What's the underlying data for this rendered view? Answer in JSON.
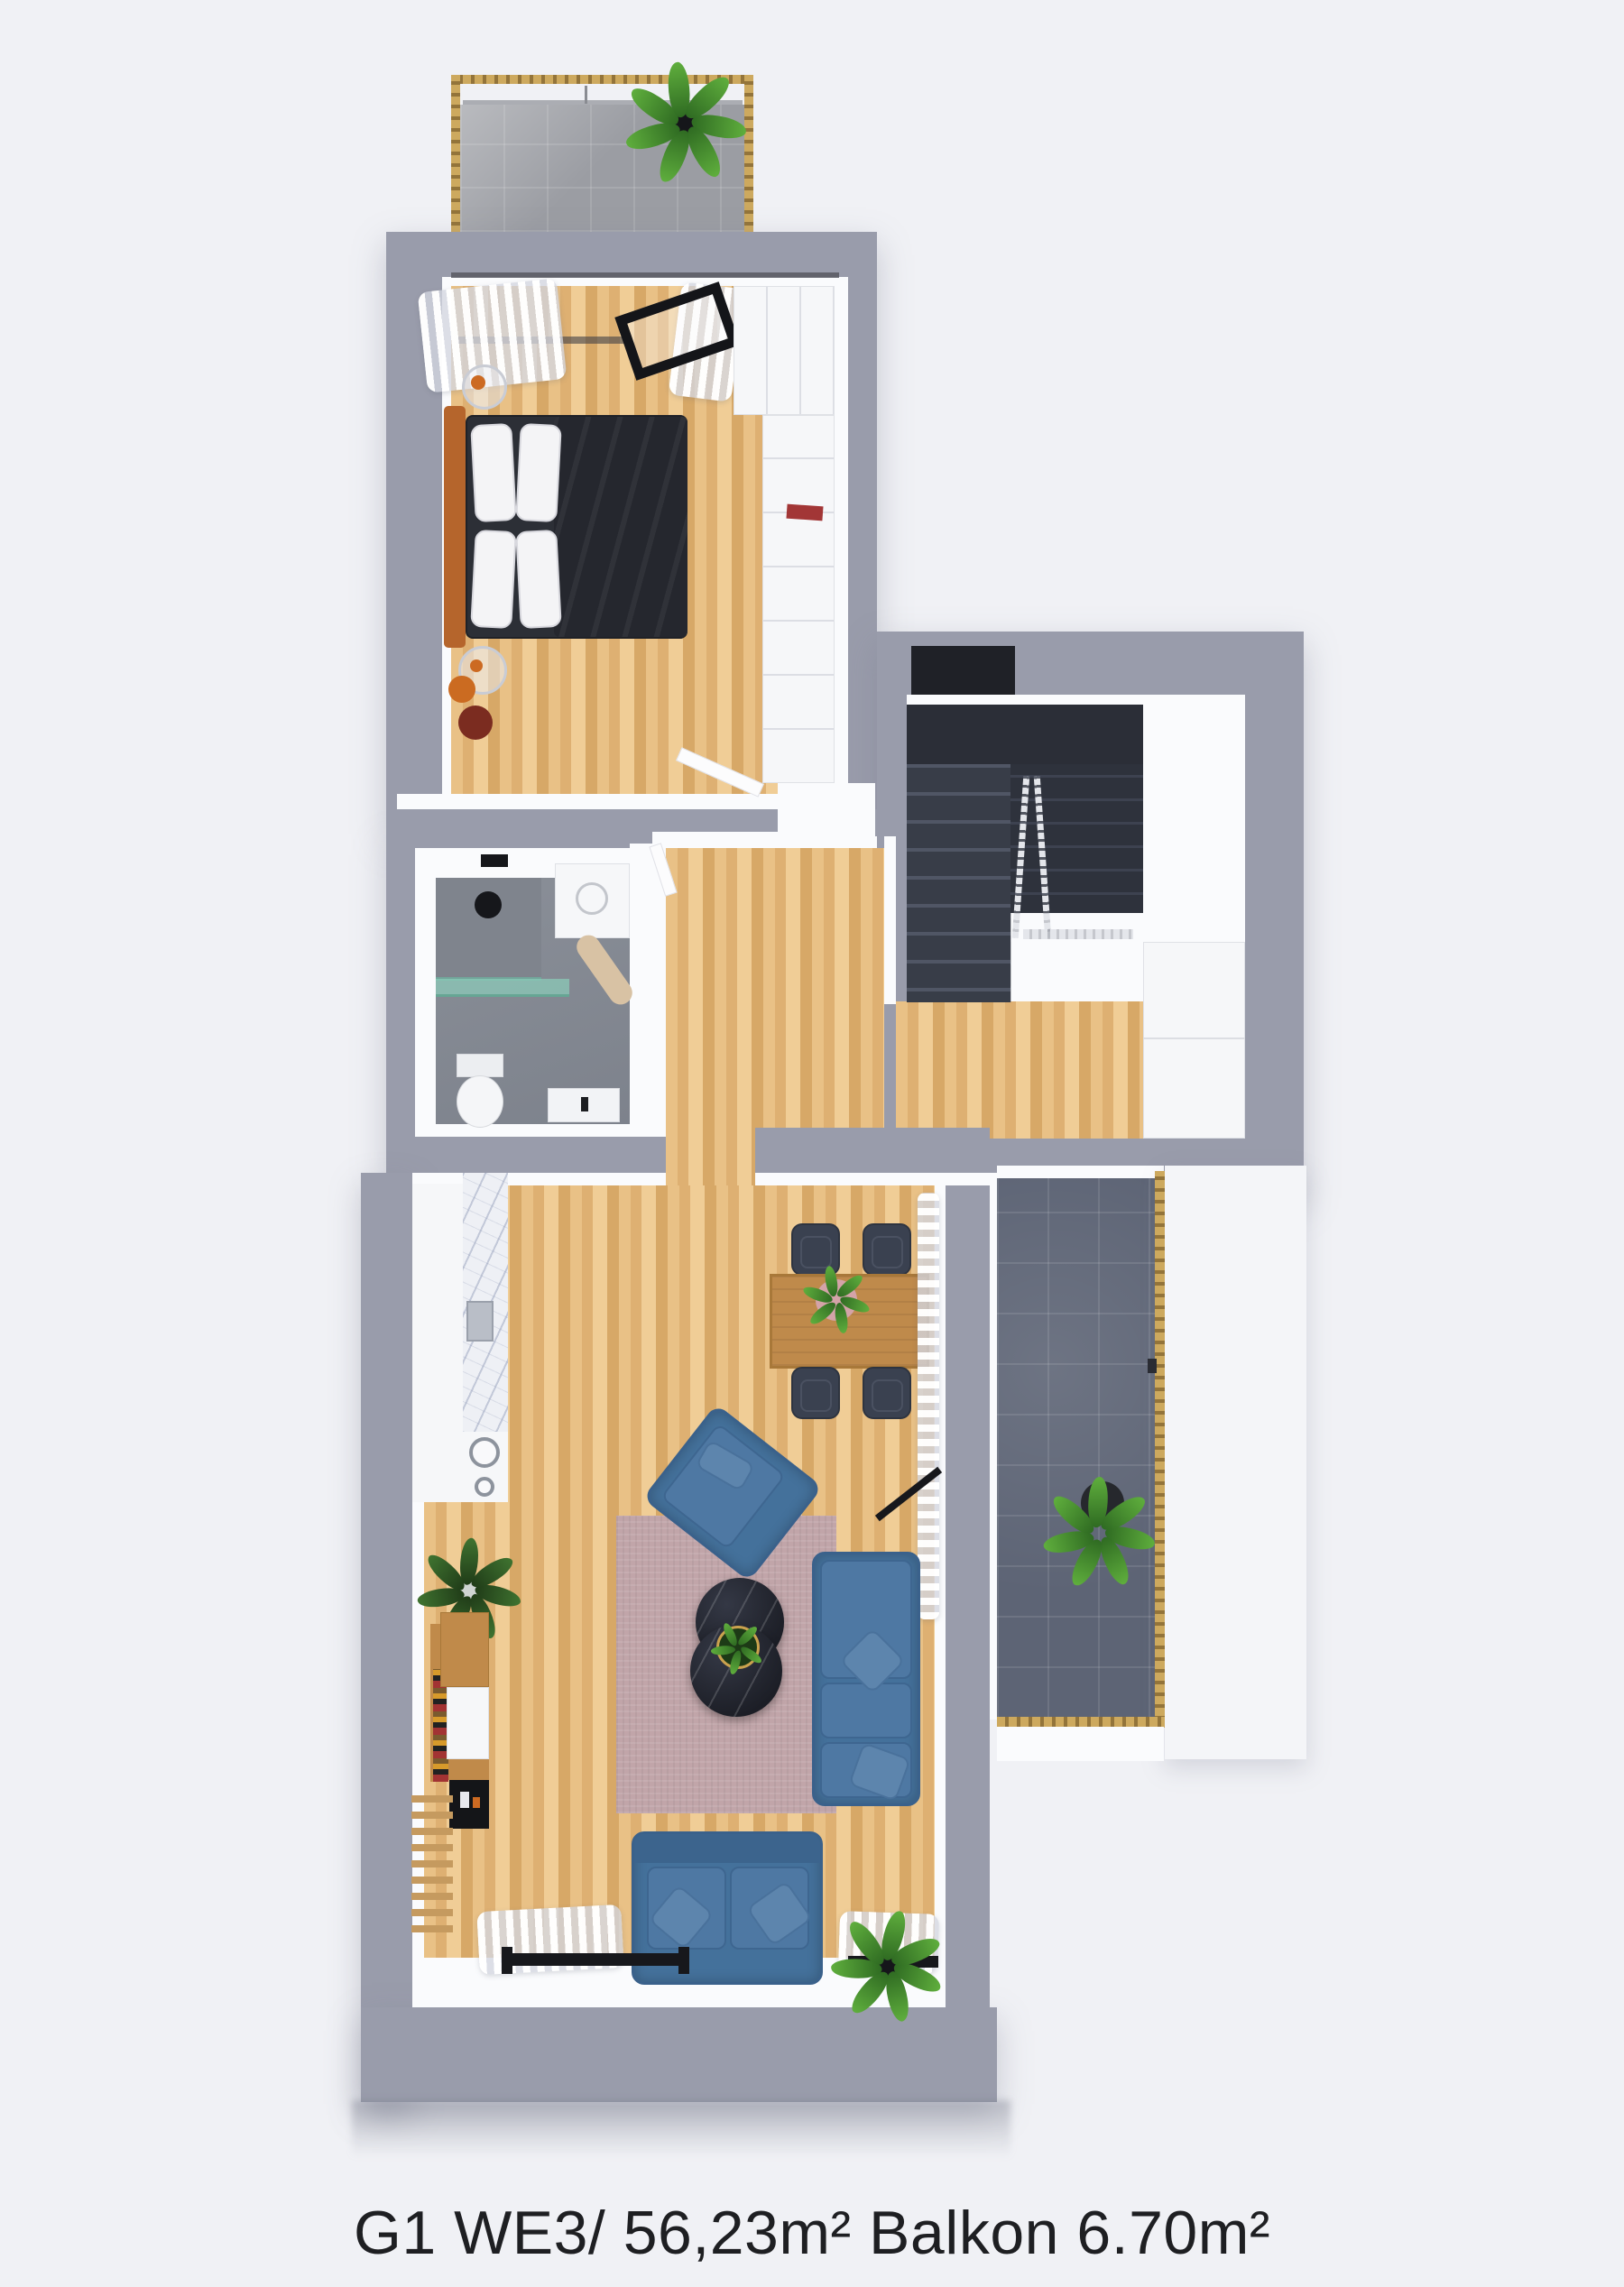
{
  "caption": {
    "text": "G1 WE3/ 56,23m² Balkon 6.70m²"
  },
  "palette": {
    "bg": "#f0f1f5",
    "wall": "#999cab",
    "lining": "#fafbfd",
    "wood_floor": "#e3b97e",
    "balcony_top_tile": "#9b9da3",
    "balcony_right_tile": "#5d6475",
    "bath_floor": "#84murd",
    "stair_dark": "#2e323c",
    "sofa": "#44719b",
    "rug": "#c1a5a9",
    "gold": "#c2a355",
    "marble_table": "#22242d",
    "dining_wood": "#bf8a4b",
    "headboard_orange": "#b5652c",
    "bed_dark": "#2c2f36",
    "plant_green": "#5fae3d",
    "caption_color": "#1e1f22"
  },
  "regions": [
    "balcony-top",
    "bedroom",
    "wardrobe",
    "hallway",
    "stairwell",
    "bathroom",
    "kitchen",
    "dining-area",
    "living-room",
    "balcony-right"
  ]
}
